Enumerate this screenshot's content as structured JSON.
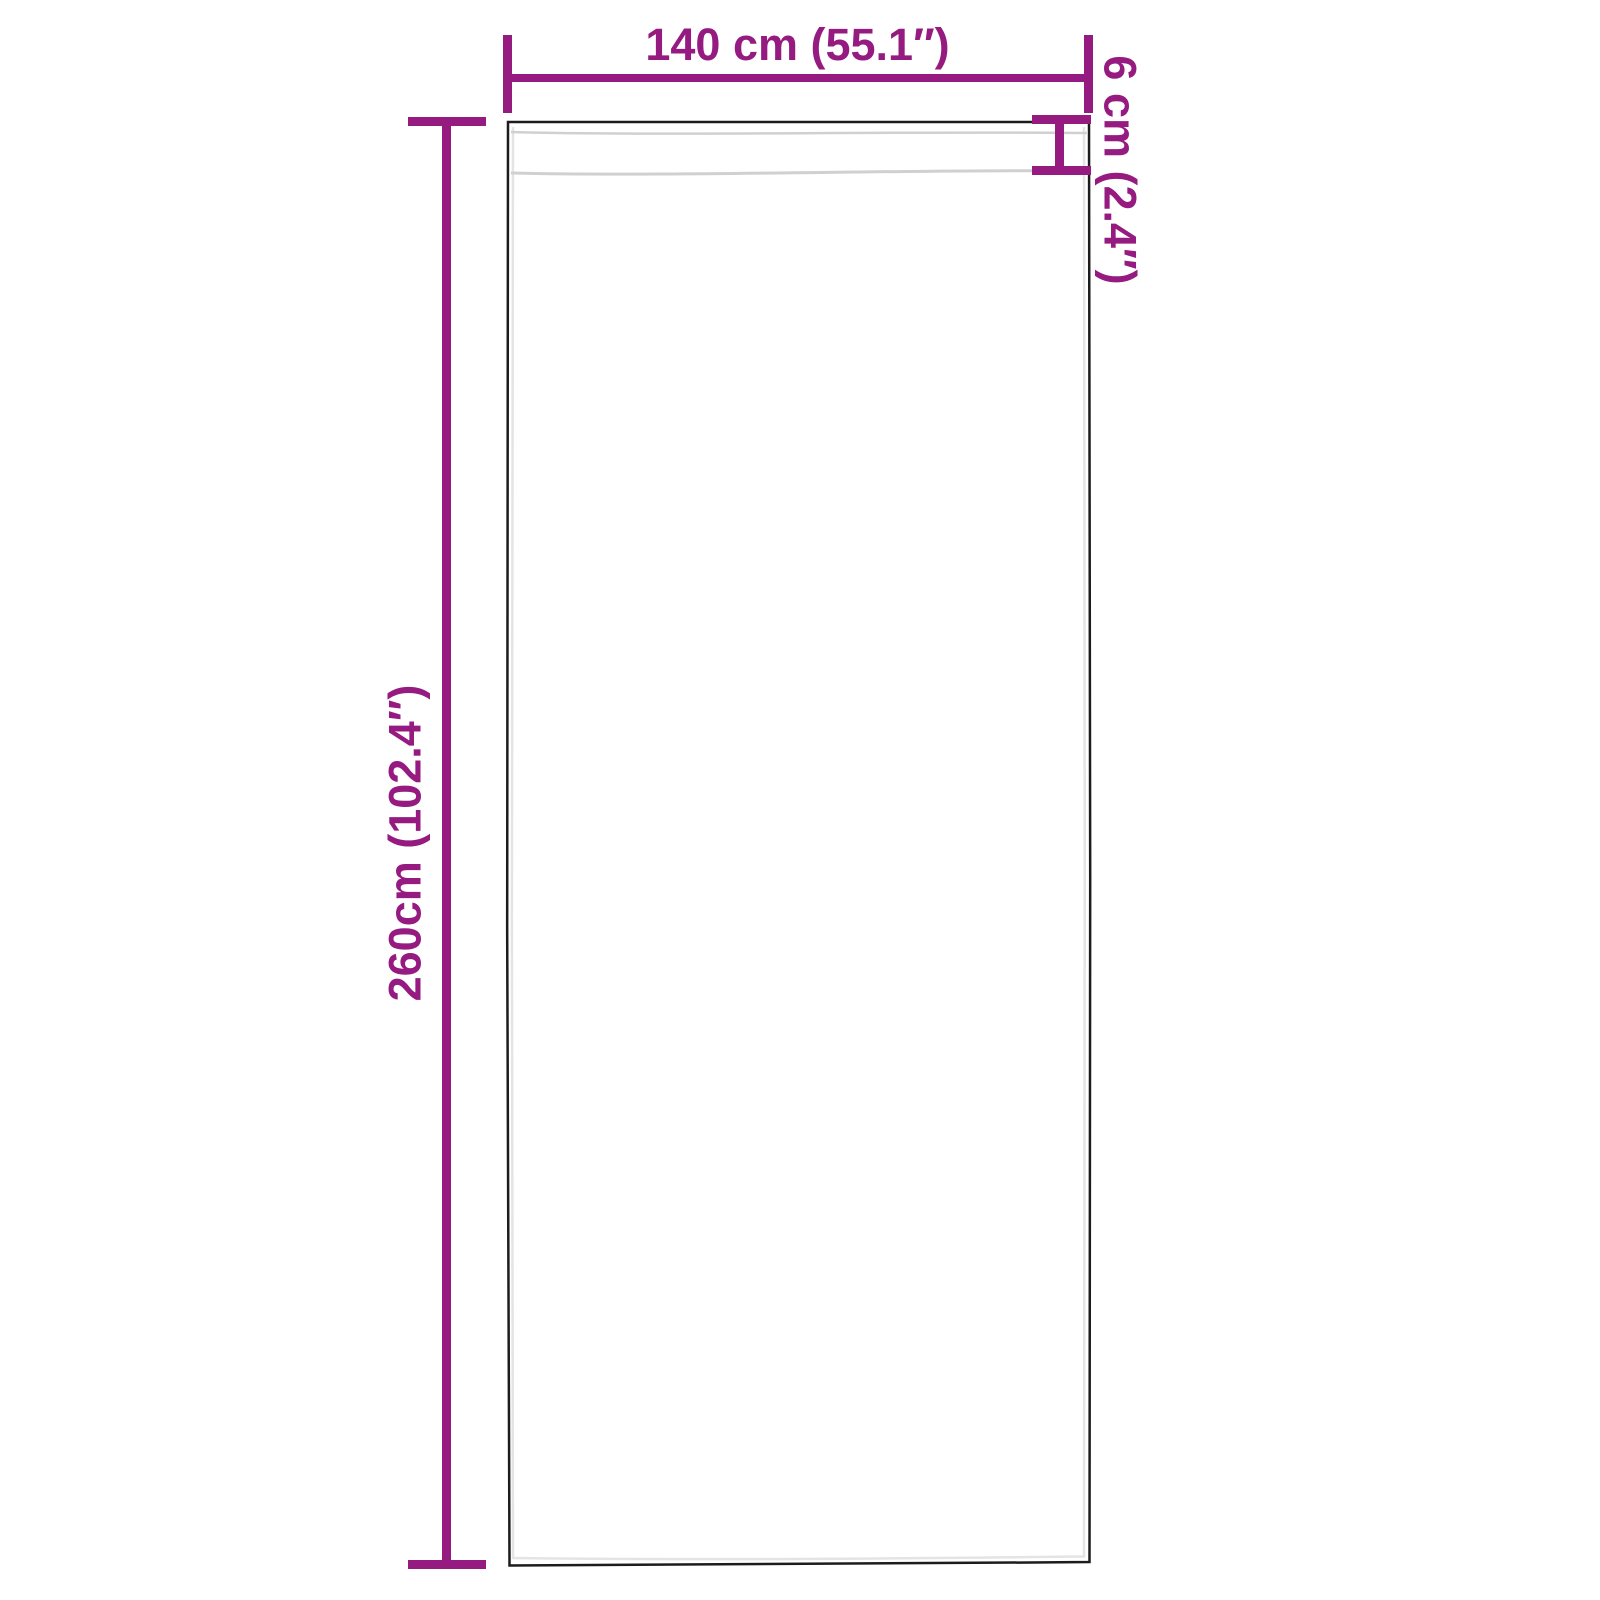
{
  "diagram": {
    "title": "Curtain panel dimension diagram",
    "accent_color": "#951b81",
    "outline_color": "#1c1c1c",
    "inner_line_color": "#e4e4e4",
    "seam_color": "#d0d0d0",
    "dimensions": {
      "width": {
        "label": "140 cm (55.1″)"
      },
      "height": {
        "label": "260cm (102.4″)"
      },
      "pocket": {
        "label": "6 cm (2.4″)"
      }
    }
  }
}
